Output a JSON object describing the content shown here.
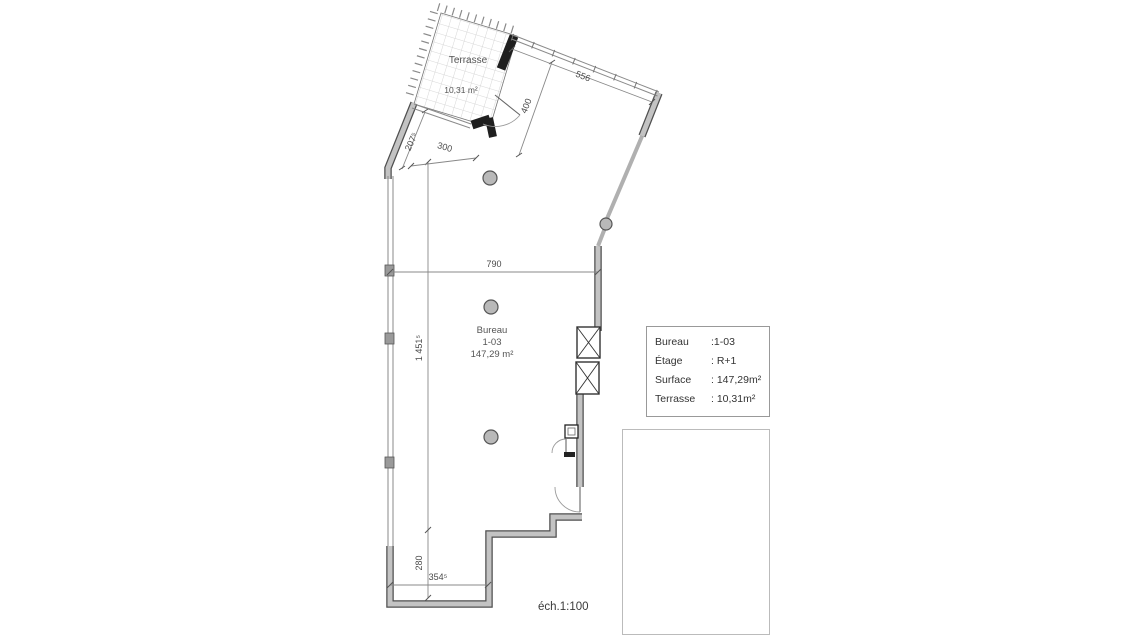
{
  "plan": {
    "terrace": {
      "label": "Terrasse",
      "area": "10,31 m²"
    },
    "office": {
      "line1": "Bureau",
      "line2": "1-03",
      "line3": "147,29 m²"
    },
    "dims": {
      "facade_top": "556",
      "depth_top": "400",
      "slant_left": "207⁵",
      "width_top": "300",
      "width_mid": "790",
      "height_left": "1 451⁵",
      "height_bottom": "280",
      "width_bottom": "354⁵"
    },
    "scale": "éch.1:100"
  },
  "info_table": {
    "rows": [
      {
        "label": "Bureau",
        "value": ":1-03"
      },
      {
        "label": "Étage",
        "value": ": R+1"
      },
      {
        "label": "Surface",
        "value": ": 147,29m²"
      },
      {
        "label": "Terrasse",
        "value": ": 10,31m²"
      }
    ]
  },
  "colors": {
    "unit_highlight": "#f0b1b6",
    "terrace_highlight": "#d4787d",
    "wall_gray": "#c3c3c3",
    "wall_edge": "#4f4f4f",
    "wall_black": "#1f1f1f",
    "dimension_line": "#888888"
  }
}
